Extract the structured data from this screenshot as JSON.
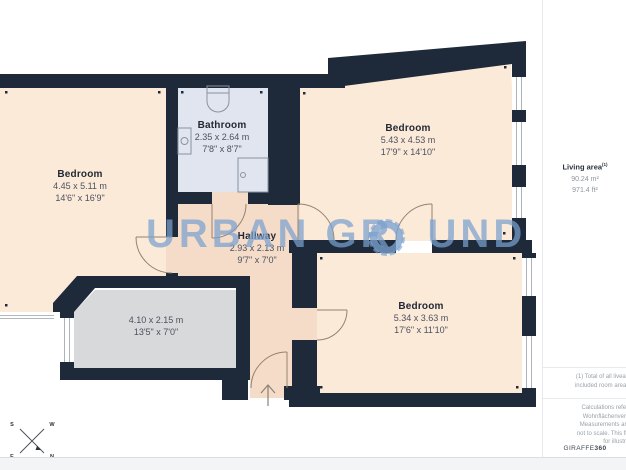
{
  "colors": {
    "wall": "#1e2a3a",
    "room_cream": "#fcead9",
    "hallway": "#f4dcc8",
    "bathroom": "#e0e5ef",
    "terrace_gray": "#d8d9da",
    "watermark_blue": "#7ba3cf",
    "door_arc": "#93836f"
  },
  "floorplan": {
    "rooms": [
      {
        "id": "bedroom-left",
        "name": "Bedroom",
        "dim_m": "4.45 x 5.11 m",
        "dim_ft": "14'6\" x 16'9\""
      },
      {
        "id": "bathroom",
        "name": "Bathroom",
        "dim_m": "2.35 x 2.64 m",
        "dim_ft": "7'8\" x 8'7\""
      },
      {
        "id": "bedroom-top-right",
        "name": "Bedroom",
        "dim_m": "5.43 x 4.53 m",
        "dim_ft": "17'9\" x 14'10\""
      },
      {
        "id": "hallway",
        "name": "Hallway",
        "dim_m": "2.93 x 2.13 m",
        "dim_ft": "9'7\" x 7'0\""
      },
      {
        "id": "terrace",
        "name": "",
        "dim_m": "4.10 x 2.15 m",
        "dim_ft": "13'5\" x 7'0\""
      },
      {
        "id": "bedroom-bottom-right",
        "name": "Bedroom",
        "dim_m": "5.34 x 3.63 m",
        "dim_ft": "17'6\" x 11'10\""
      }
    ],
    "watermark_left": "URBAN GR",
    "watermark_right": "UND",
    "compass": {
      "n": "N",
      "s": "S",
      "e": "E",
      "w": "W"
    }
  },
  "sidebar": {
    "living_area_label": "Living area",
    "living_area_sup": "(1)",
    "living_area_m2": "90.24 m²",
    "living_area_ft2": "971.4 ft²",
    "footnote_line1": "(1) Total of all liveable fully and partially",
    "footnote_line2": "included room areas (100%, 50%, 25%)",
    "disclaimer_line1": "Calculations reference the German",
    "disclaimer_line2": "Wohnflächenverordnung (WoFlV).",
    "disclaimer_line3": "Measurements are approximate and",
    "disclaimer_line4": "not to scale. This floor plan is intended",
    "disclaimer_line5": "for illustration only.",
    "brand_name": "GIRAFFE",
    "brand_suffix": "360"
  }
}
